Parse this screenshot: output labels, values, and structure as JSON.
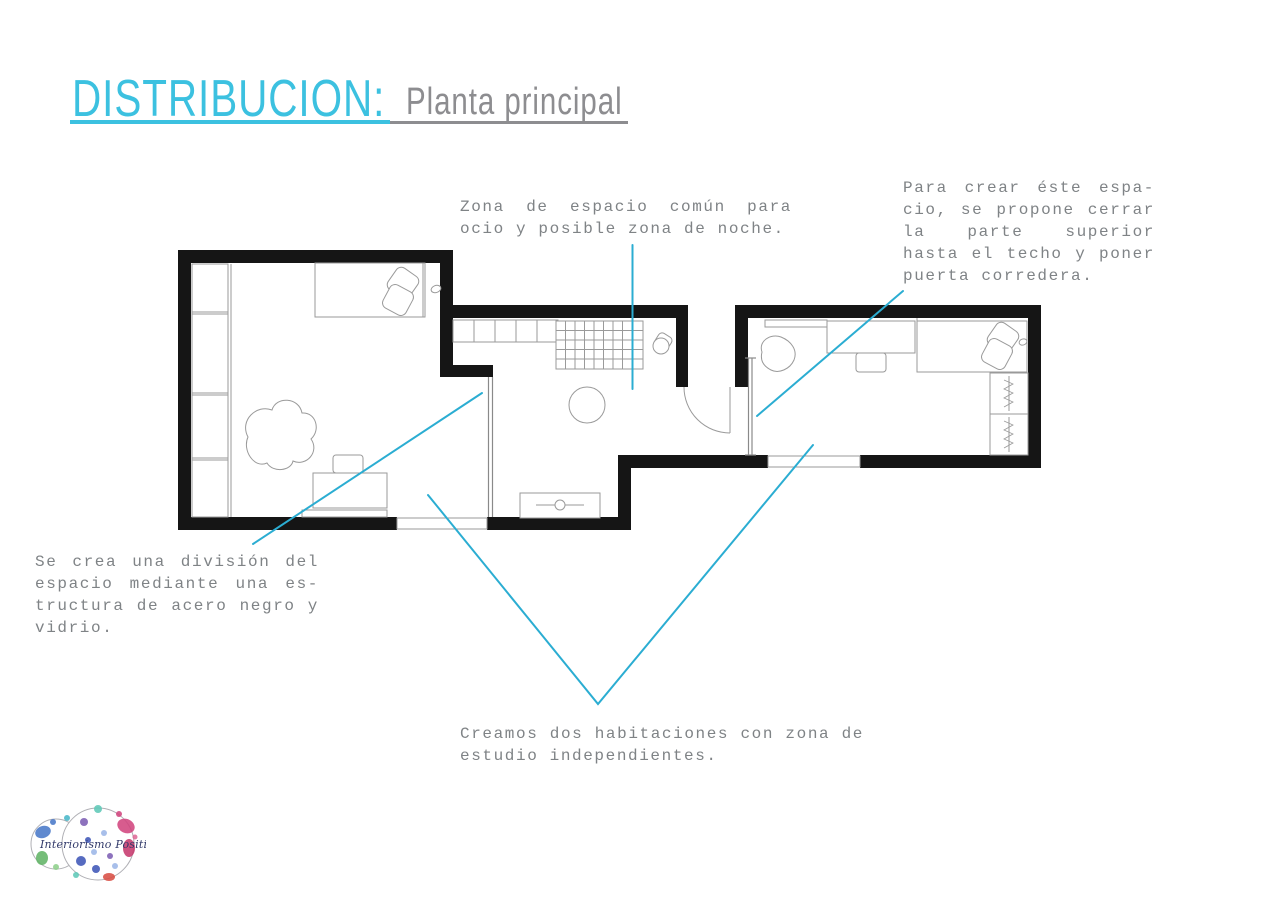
{
  "title": {
    "main": "DISTRIBUCION:",
    "sub": "Planta principal"
  },
  "annotations": {
    "common_zone": {
      "lines": [
        "Zona de espacio común para",
        "ocio y posible zona de noche."
      ]
    },
    "sliding_door": {
      "lines": [
        "Para crear éste espa-",
        "cio, se propone cerrar",
        "la parte superior",
        "hasta el techo y poner",
        "puerta corredera."
      ]
    },
    "glass_division": {
      "lines": [
        "Se crea una división del",
        "espacio mediante una es-",
        "tructura de acero negro y",
        "vidrio."
      ]
    },
    "two_rooms": {
      "lines": [
        "Creamos dos habitaciones con zona de",
        "estudio independientes."
      ]
    }
  },
  "logo": {
    "text": "Interiorismo Positivo"
  },
  "colors": {
    "title_accent": "#3cc1e0",
    "title_gray": "#8d8d90",
    "annotation_text": "#7f8386",
    "leader_line": "#2badd2",
    "wall": "#151515",
    "furniture_line": "#9a9a9a"
  }
}
